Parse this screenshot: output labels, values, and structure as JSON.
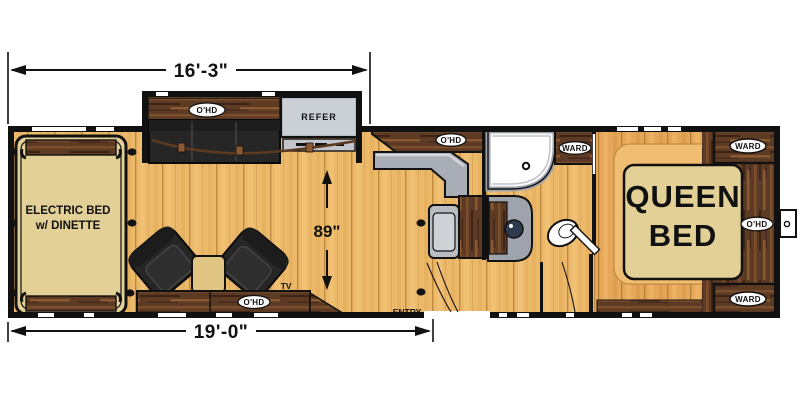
{
  "title": "Toy hauler travel trailer floor plan",
  "dimensions": {
    "exterior_top": "16'-3\"",
    "exterior_bottom": "19'-0\"",
    "garage_interior": "89\""
  },
  "labels": {
    "overhead_cabinet": "O'HD",
    "wardrobe": "WARD",
    "refrigerator": "REFER",
    "entry": "ENTRY",
    "tv": "TV",
    "electric_bed_line1": "ELECTRIC BED",
    "electric_bed_line2": "w/ DINETTE",
    "queen_bed_line1": "QUEEN",
    "queen_bed_line2": "BED"
  },
  "colors": {
    "background": "#FFFFFF",
    "wall": "#111111",
    "floor": "#ECB96B",
    "bedroom_floor": "#E5A75A",
    "platform": "#EFBE72",
    "dark_wood": "#5D3A23",
    "upholstery": "#262626",
    "mattress_tan": "#E2D097",
    "counter_gray": "#A9AEB6",
    "refrigerator_gray": "#CBD0D6"
  }
}
